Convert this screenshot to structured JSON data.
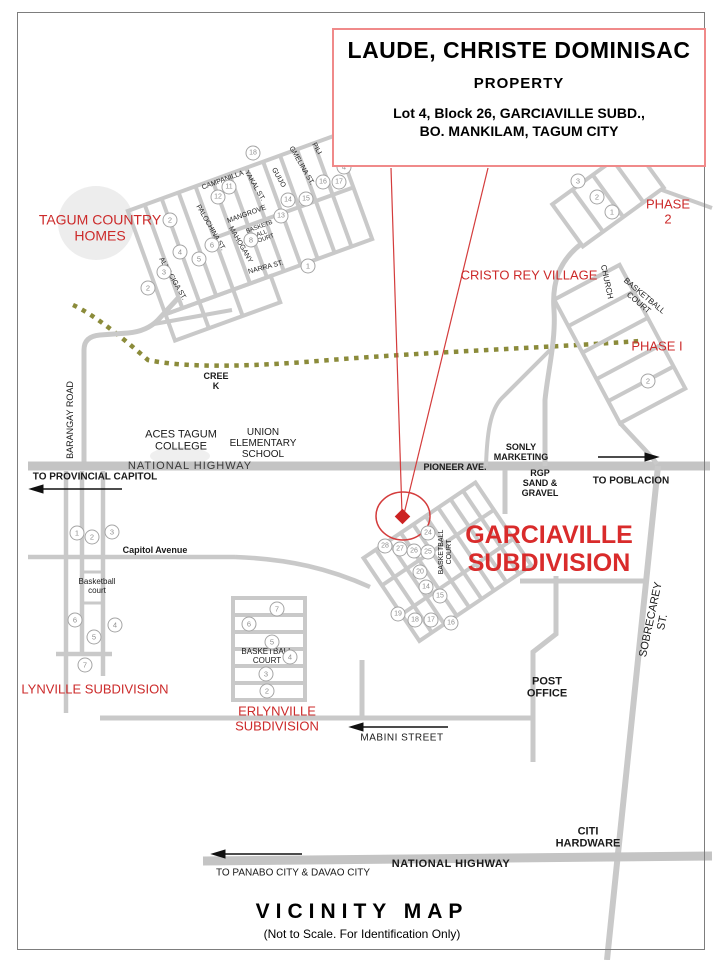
{
  "map": {
    "title_box": {
      "owner": "LAUDE, CHRISTE DOMINISAC",
      "kind": "PROPERTY",
      "address_line1": "Lot 4, Block 26, GARCIAVILLE SUBD.,",
      "address_line2": "BO. MANKILAM, TAGUM CITY"
    },
    "footer": {
      "title": "VICINITY  MAP",
      "subtitle": "(Not to Scale. For Identification Only)"
    },
    "colors": {
      "red_text": "#cc2a2a",
      "box_border": "#f08a8a",
      "road_gray": "#c9c9c9",
      "creek_olive": "#8b8b3a",
      "callout_red": "#d43c3c"
    },
    "labels": [
      {
        "name": "label-national-highway-upper",
        "text": "NATIONAL HIGHWAY",
        "x": 190,
        "y": 466,
        "size": 11,
        "spacing": 1,
        "color": "#3a3a3a"
      },
      {
        "name": "label-pioneer-ave",
        "text": "PIONEER AVE.",
        "x": 455,
        "y": 467,
        "size": 9,
        "bold": true
      },
      {
        "name": "label-sonly-marketing",
        "text": "SONLY\nMARKETING",
        "x": 521,
        "y": 452,
        "size": 9,
        "bold": true
      },
      {
        "name": "label-rgp-sand-gravel",
        "text": "RGP\nSAND &\nGRAVEL",
        "x": 540,
        "y": 483,
        "size": 9,
        "bold": true
      },
      {
        "name": "label-to-poblacion",
        "text": "TO POBLACION",
        "x": 631,
        "y": 481,
        "size": 10,
        "bold": true
      },
      {
        "name": "label-to-provincial-capitol",
        "text": "TO PROVINCIAL CAPITOL",
        "x": 95,
        "y": 477,
        "size": 10,
        "bold": true
      },
      {
        "name": "label-aces-tagum-college",
        "text": "ACES TAGUM\nCOLLEGE",
        "x": 181,
        "y": 441,
        "size": 11
      },
      {
        "name": "label-union-elementary-school",
        "text": "UNION\nELEMENTARY\nSCHOOL",
        "x": 263,
        "y": 444,
        "size": 10
      },
      {
        "name": "label-creek",
        "text": "CREE\nK",
        "x": 216,
        "y": 381,
        "size": 9,
        "bold": true
      },
      {
        "name": "label-barangay-road",
        "text": "BARANGAY ROAD",
        "x": 70,
        "y": 420,
        "size": 9,
        "rotate": -90
      },
      {
        "name": "label-capitol-avenue",
        "text": "Capitol Avenue",
        "x": 155,
        "y": 550,
        "size": 9,
        "bold": true
      },
      {
        "name": "label-lynville-basketball-court",
        "text": "Basketball\ncourt",
        "x": 97,
        "y": 587,
        "size": 8
      },
      {
        "name": "label-erlynville-basketball-court",
        "text": "BASKETBALL\nCOURT",
        "x": 267,
        "y": 657,
        "size": 8
      },
      {
        "name": "label-garciaville-basketball-court",
        "text": "BASKETBALL\nCOURT",
        "x": 446,
        "y": 552,
        "size": 7,
        "rotate": -90
      },
      {
        "name": "label-phase1-basketball-court",
        "text": "BASKETBALL\nCOURT",
        "x": 641,
        "y": 300,
        "size": 8,
        "rotate": 40
      },
      {
        "name": "label-church",
        "text": "CHURCH",
        "x": 606,
        "y": 282,
        "size": 8,
        "rotate": 78
      },
      {
        "name": "label-post-office",
        "text": "POST\nOFFICE",
        "x": 547,
        "y": 688,
        "size": 11,
        "bold": true
      },
      {
        "name": "label-sobrecarey-st",
        "text": "SOBRECAREY ST.",
        "x": 657,
        "y": 621,
        "size": 11,
        "rotate": -78
      },
      {
        "name": "label-citi-hardware",
        "text": "CITI\nHARDWARE",
        "x": 588,
        "y": 838,
        "size": 11,
        "bold": true
      },
      {
        "name": "label-national-highway-lower",
        "text": "NATIONAL HIGHWAY",
        "x": 451,
        "y": 864,
        "size": 11,
        "bold": true,
        "spacing": 0.5
      },
      {
        "name": "label-to-panabo-davao",
        "text": "TO PANABO CITY  & DAVAO CITY",
        "x": 293,
        "y": 873,
        "size": 10
      },
      {
        "name": "label-mabini-street",
        "text": "MABINI STREET",
        "x": 402,
        "y": 738,
        "size": 10,
        "spacing": 0.5
      },
      {
        "name": "label-tagum-country-homes",
        "text": "TAGUM COUNTRY\nHOMES",
        "x": 100,
        "y": 228,
        "size": 14,
        "color": "#cc2a2a"
      },
      {
        "name": "label-cristo-rey-village",
        "text": "CRISTO REY VILLAGE",
        "x": 529,
        "y": 276,
        "size": 13,
        "color": "#cc2a2a"
      },
      {
        "name": "label-phase-2",
        "text": "PHASE 2",
        "x": 668,
        "y": 212,
        "size": 13,
        "color": "#cc2a2a"
      },
      {
        "name": "label-phase-1",
        "text": "PHASE I",
        "x": 657,
        "y": 347,
        "size": 13,
        "color": "#cc2a2a"
      },
      {
        "name": "label-garciaville-subdivision",
        "text": "GARCIAVILLE\nSUBDIVISION",
        "x": 549,
        "y": 549,
        "size": 25,
        "bold": true,
        "color": "#d92b2b"
      },
      {
        "name": "label-lynville-subdivision",
        "text": "LYNVILLE  SUBDIVISION",
        "x": 95,
        "y": 690,
        "size": 13,
        "color": "#cc2a2a"
      },
      {
        "name": "label-erlynville-subdivision",
        "text": "ERLYNVILLE\nSUBDIVISION",
        "x": 277,
        "y": 719,
        "size": 13,
        "color": "#cc2a2a"
      },
      {
        "name": "label-campanilla-st",
        "text": "CAMPANILLA",
        "x": 223,
        "y": 181,
        "size": 7,
        "rotate": -20,
        "color": "#222222"
      },
      {
        "name": "label-yakal-st",
        "text": "YAKAL ST.",
        "x": 254,
        "y": 186,
        "size": 7,
        "rotate": 60,
        "color": "#222222"
      },
      {
        "name": "label-guijo-st",
        "text": "GUIJO",
        "x": 278,
        "y": 178,
        "size": 7,
        "rotate": 60,
        "color": "#222222"
      },
      {
        "name": "label-gmelina-st",
        "text": "GMELINA ST.",
        "x": 301,
        "y": 166,
        "size": 7,
        "rotate": 60,
        "color": "#222222"
      },
      {
        "name": "label-pili-st",
        "text": "PILI",
        "x": 316,
        "y": 149,
        "size": 7,
        "rotate": 60,
        "color": "#222222"
      },
      {
        "name": "label-mangrove-st",
        "text": "MANGROVE",
        "x": 247,
        "y": 215,
        "size": 7,
        "rotate": -20,
        "color": "#222222"
      },
      {
        "name": "label-tch-basketball-court",
        "text": "BASKETB\nALL\nCOURT",
        "x": 262,
        "y": 234,
        "size": 6,
        "rotate": -20,
        "color": "#222222"
      },
      {
        "name": "label-mahogany-st",
        "text": "MAHOGANY",
        "x": 240,
        "y": 245,
        "size": 7,
        "rotate": 60,
        "color": "#222222"
      },
      {
        "name": "label-palochina-st",
        "text": "PALOCHINA ST.",
        "x": 210,
        "y": 228,
        "size": 7,
        "rotate": 60,
        "color": "#222222"
      },
      {
        "name": "label-almaciga-st",
        "text": "ALMACIGA ST.",
        "x": 172,
        "y": 279,
        "size": 7,
        "rotate": 60,
        "color": "#222222"
      },
      {
        "name": "label-narra-st",
        "text": "NARRA ST.",
        "x": 266,
        "y": 268,
        "size": 7,
        "rotate": -15,
        "color": "#222222"
      }
    ],
    "circled_numbers": [
      {
        "n": "2",
        "x": 170,
        "y": 220
      },
      {
        "n": "2",
        "x": 148,
        "y": 288
      },
      {
        "n": "18",
        "x": 253,
        "y": 153
      },
      {
        "n": "12",
        "x": 218,
        "y": 197
      },
      {
        "n": "11",
        "x": 229,
        "y": 187
      },
      {
        "n": "13",
        "x": 281,
        "y": 216
      },
      {
        "n": "14",
        "x": 288,
        "y": 200
      },
      {
        "n": "15",
        "x": 306,
        "y": 199
      },
      {
        "n": "16",
        "x": 323,
        "y": 182
      },
      {
        "n": "17",
        "x": 339,
        "y": 182
      },
      {
        "n": "8",
        "x": 251,
        "y": 240
      },
      {
        "n": "6",
        "x": 212,
        "y": 245
      },
      {
        "n": "5",
        "x": 199,
        "y": 259
      },
      {
        "n": "4",
        "x": 180,
        "y": 252
      },
      {
        "n": "3",
        "x": 164,
        "y": 272
      },
      {
        "n": "1",
        "x": 308,
        "y": 266
      },
      {
        "n": "4",
        "x": 344,
        "y": 167
      },
      {
        "n": "3",
        "x": 578,
        "y": 181
      },
      {
        "n": "2",
        "x": 597,
        "y": 197
      },
      {
        "n": "1",
        "x": 612,
        "y": 212
      },
      {
        "n": "2",
        "x": 648,
        "y": 381
      },
      {
        "n": "1",
        "x": 77,
        "y": 533
      },
      {
        "n": "2",
        "x": 92,
        "y": 537
      },
      {
        "n": "3",
        "x": 112,
        "y": 532
      },
      {
        "n": "6",
        "x": 75,
        "y": 620
      },
      {
        "n": "5",
        "x": 94,
        "y": 637
      },
      {
        "n": "4",
        "x": 115,
        "y": 625
      },
      {
        "n": "7",
        "x": 85,
        "y": 665
      },
      {
        "n": "7",
        "x": 277,
        "y": 609
      },
      {
        "n": "6",
        "x": 249,
        "y": 624
      },
      {
        "n": "5",
        "x": 272,
        "y": 642
      },
      {
        "n": "4",
        "x": 290,
        "y": 657
      },
      {
        "n": "3",
        "x": 266,
        "y": 674
      },
      {
        "n": "2",
        "x": 267,
        "y": 691
      },
      {
        "n": "24",
        "x": 428,
        "y": 533
      },
      {
        "n": "28",
        "x": 385,
        "y": 546
      },
      {
        "n": "27",
        "x": 400,
        "y": 549
      },
      {
        "n": "26",
        "x": 414,
        "y": 551
      },
      {
        "n": "25",
        "x": 428,
        "y": 552
      },
      {
        "n": "20",
        "x": 420,
        "y": 572
      },
      {
        "n": "14",
        "x": 426,
        "y": 587
      },
      {
        "n": "15",
        "x": 440,
        "y": 596
      },
      {
        "n": "19",
        "x": 398,
        "y": 614
      },
      {
        "n": "18",
        "x": 415,
        "y": 620
      },
      {
        "n": "17",
        "x": 431,
        "y": 620
      },
      {
        "n": "16",
        "x": 451,
        "y": 623
      }
    ]
  }
}
